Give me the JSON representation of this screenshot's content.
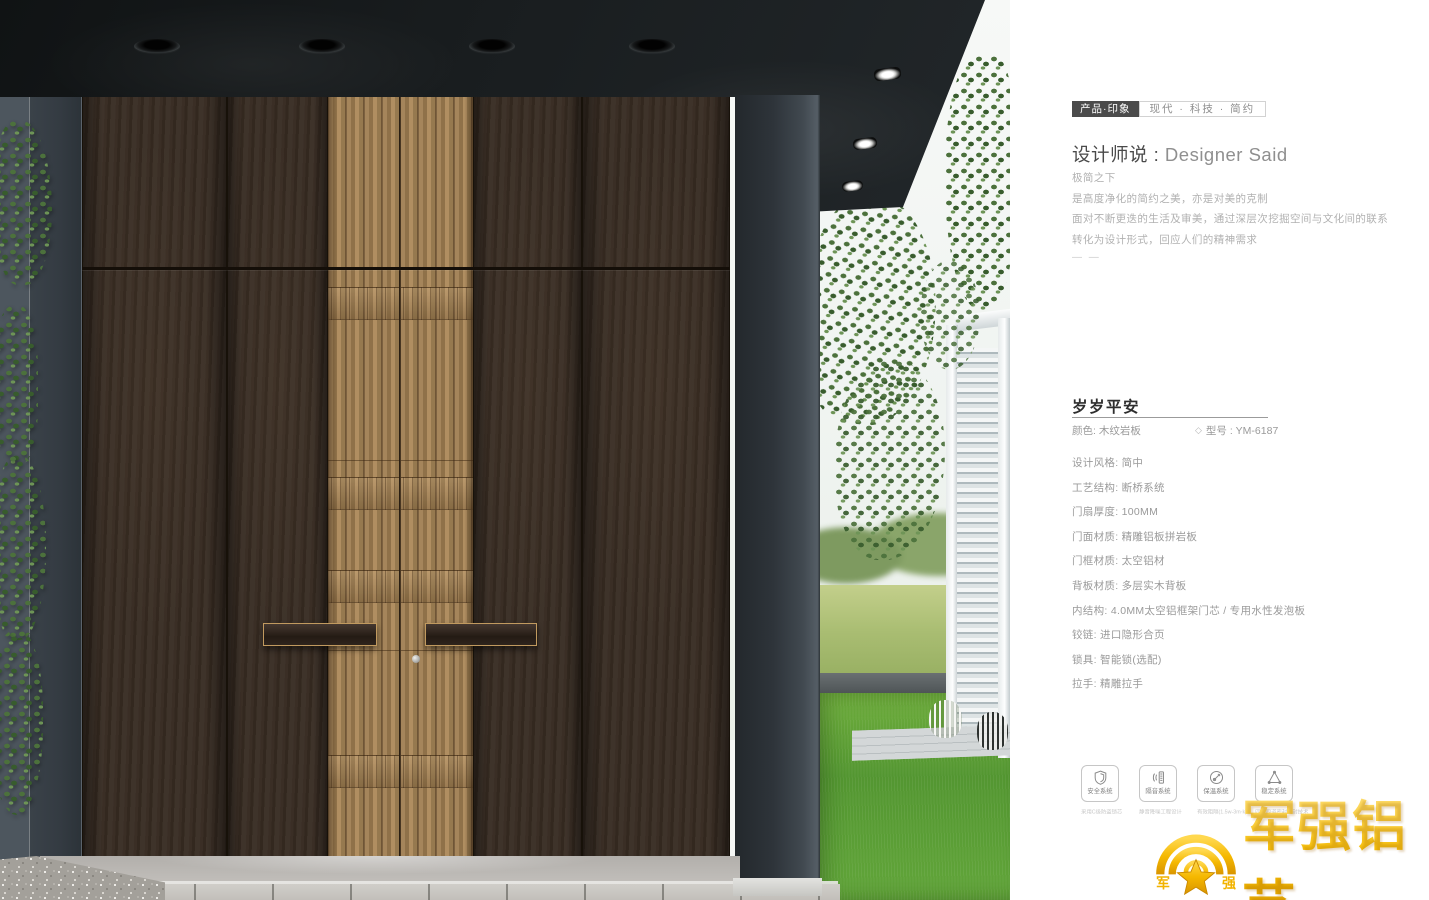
{
  "header": {
    "badge": "产品·印象",
    "tags": "现代 · 科技 · 简约"
  },
  "designer": {
    "title_cn": "设计师说 : ",
    "title_en": "Designer Said",
    "line1": "极简之下",
    "line2": "是高度净化的简约之美，亦是对美的克制",
    "line3": "面对不断更迭的生活及审美，通过深层次挖掘空间与文化间的联系",
    "line4": "转化为设计形式，回应人们的精神需求",
    "dashes": "— —"
  },
  "product": {
    "name": "岁岁平安",
    "color_label": "颜色: 木纹岩板",
    "model_label": "型号 : YM-6187",
    "diamond_icon": "◇"
  },
  "specs": [
    "设计风格: 简中",
    "工艺结构: 断桥系统",
    "门扇厚度: 100MM",
    "门面材质: 精雕铝板拼岩板",
    "门框材质: 太空铝材",
    "背板材质: 多层实木背板",
    "内结构: 4.0MM太空铝框架门芯 / 专用水性发泡板",
    "铰链: 进口隐形合页",
    "锁具: 智能锁(选配)",
    "拉手: 精雕拉手"
  ],
  "features": [
    {
      "label": "安全系统",
      "caption": "采用C级防盗锁芯",
      "icon": "shield-icon"
    },
    {
      "label": "隔音系统",
      "caption": "静音降噪工程设计",
      "icon": "soundproof-icon"
    },
    {
      "label": "保温系统",
      "caption": "有效阻隔(1.5w-3m·k)",
      "icon": "insulation-icon"
    },
    {
      "label": "稳定系统",
      "caption": "四面四道密封门封技术",
      "icon": "stability-icon"
    }
  ],
  "logo": {
    "text": "军强铝艺",
    "emblem_left": "军",
    "emblem_right": "强"
  },
  "colors": {
    "gold": "#f2b300",
    "badge_bg": "#4b4b4b",
    "text_gray": "#9a9a9a",
    "bronze": "#a28257",
    "wood": "#362b22"
  }
}
